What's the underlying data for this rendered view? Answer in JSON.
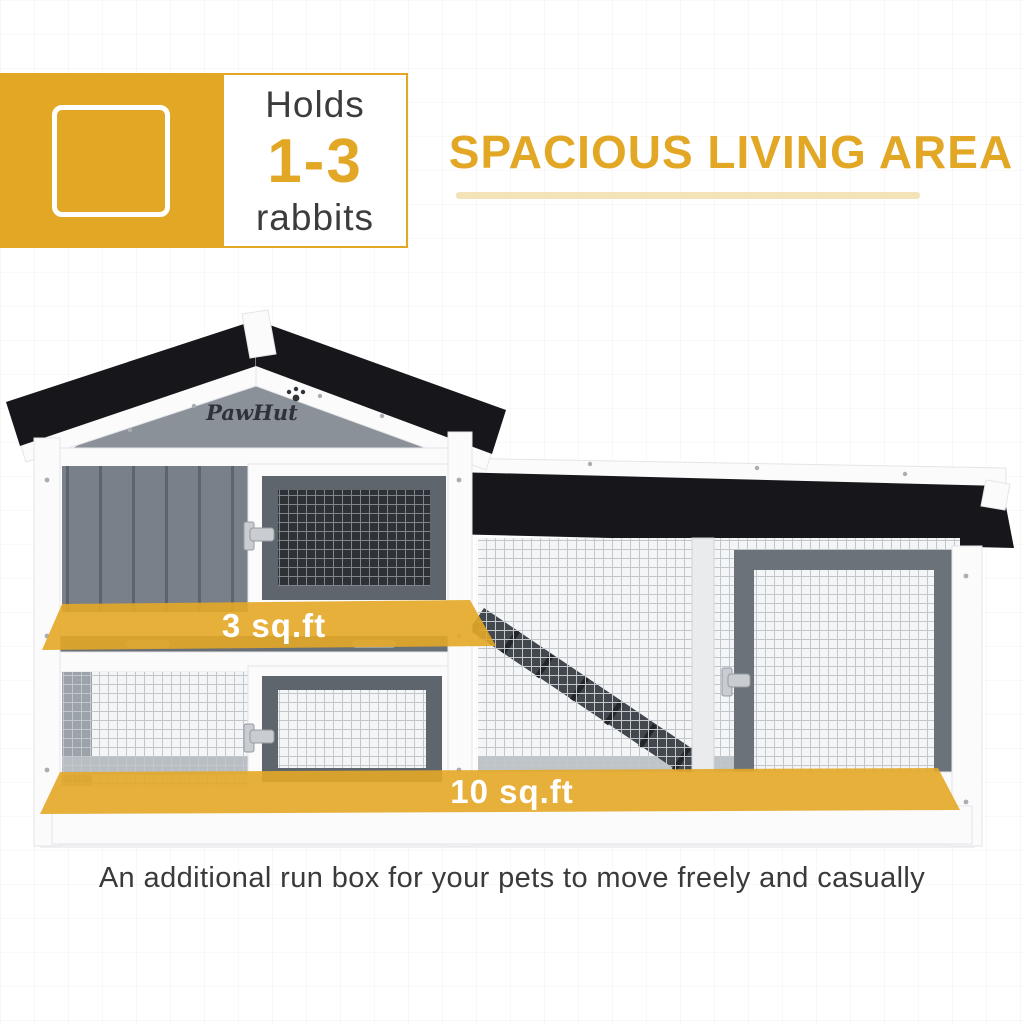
{
  "badge": {
    "heading": "Holds",
    "count": "1-3",
    "subject": "rabbits"
  },
  "title": "SPACIOUS LIVING AREA",
  "product": {
    "brand": "PawHut",
    "upper_level_area": "3 sq.ft",
    "run_area": "10 sq.ft"
  },
  "caption": "An additional run box for your pets to move freely and casually",
  "colors": {
    "accent_gold": "#E3A726",
    "underline_gold": "#F4E2B8",
    "text_dark": "#3C3C3C",
    "roof_black": "#17171B",
    "label_white": "#FFFFFF"
  }
}
